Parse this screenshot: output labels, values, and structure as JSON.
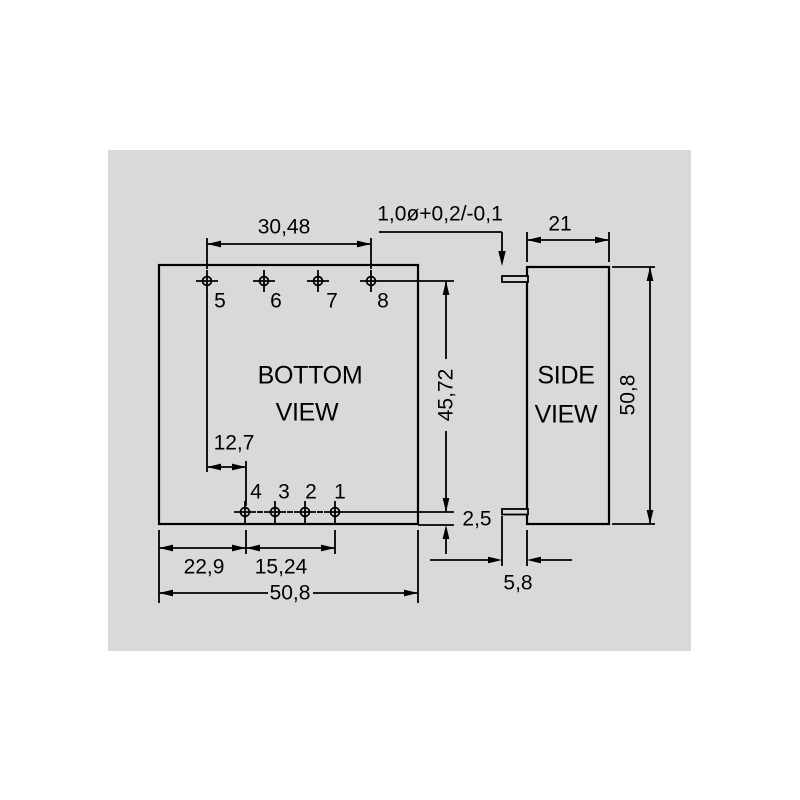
{
  "drawing": {
    "canvas_bg": "#d9d9d9",
    "line_color": "#000000",
    "bottom_view": {
      "title_line1": "BOTTOM",
      "title_line2": "VIEW",
      "top_pin_labels": [
        "5",
        "6",
        "7",
        "8"
      ],
      "bottom_pin_labels": [
        "4",
        "3",
        "2",
        "1"
      ]
    },
    "side_view": {
      "title_line1": "SIDE",
      "title_line2": "VIEW"
    },
    "dimensions": {
      "pin_span_top": "30,48",
      "pin_diameter_tolerance": "1,0ø+0,2/-0,1",
      "side_width": "21",
      "pin_rows_distance": "45,72",
      "side_height": "50,8",
      "pin_offset_left": "12,7",
      "pin_row_bottom_offset": "2,5",
      "left_edge_to_pin4": "22,9",
      "pin_span_bottom": "15,24",
      "body_width": "50,8",
      "pin_protrusion": "5,8"
    }
  }
}
